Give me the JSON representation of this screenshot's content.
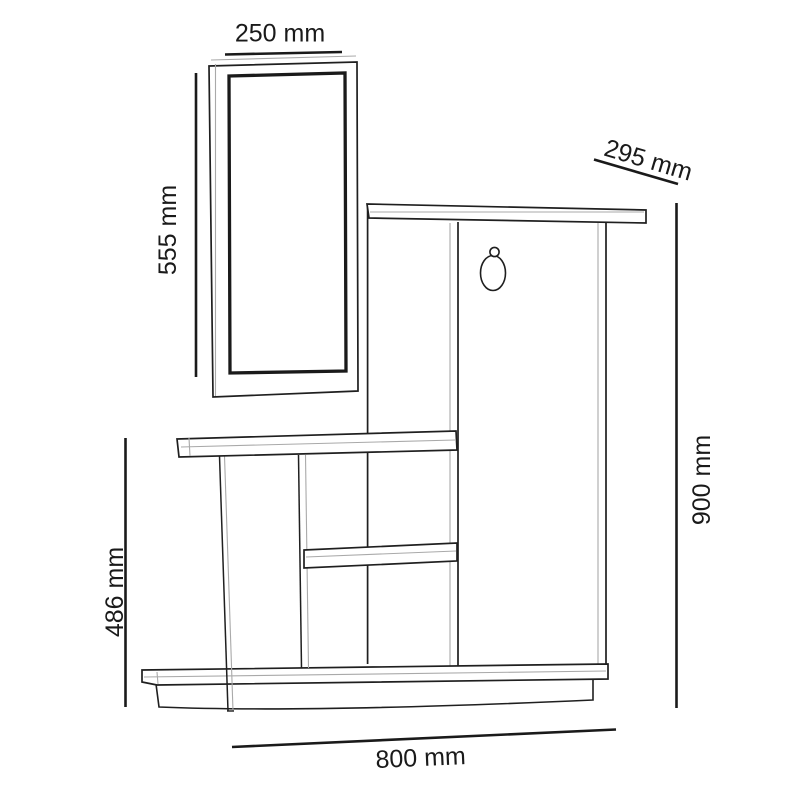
{
  "diagram": {
    "title": "hallway-stand-with-mirror-dimension-drawing",
    "unit": "mm",
    "dimensions": {
      "mirror_width": {
        "label": "250 mm",
        "value": 250
      },
      "mirror_height": {
        "label": "555 mm",
        "value": 555
      },
      "depth": {
        "label": "295 mm",
        "value": 295
      },
      "total_height": {
        "label": "900 mm",
        "value": 900
      },
      "shelf_height": {
        "label": "486 mm",
        "value": 486
      },
      "total_width": {
        "label": "800 mm",
        "value": 800
      }
    },
    "colors": {
      "line": "#1f1f1f",
      "soft": "#a9a9a9",
      "ink": "#1a1a1a",
      "background": "#ffffff"
    }
  }
}
